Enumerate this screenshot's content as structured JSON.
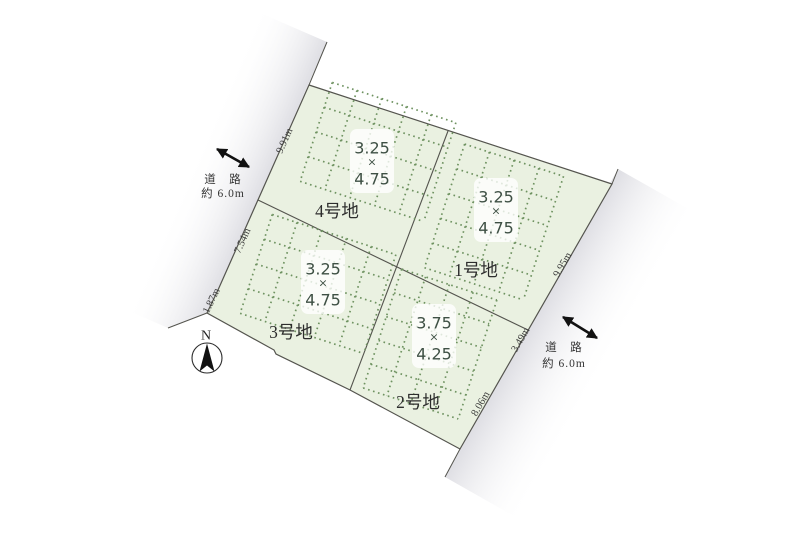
{
  "diagram": {
    "compass_label": "N",
    "roads": {
      "west": {
        "line1": "道　路",
        "line2": "約 6.0m"
      },
      "east": {
        "line1": "道　路",
        "line2": "約 6.0m"
      }
    },
    "lots": [
      {
        "name": "1号地",
        "dim_w": "3.25",
        "dim_x": "×",
        "dim_h": "4.75"
      },
      {
        "name": "2号地",
        "dim_w": "3.75",
        "dim_x": "×",
        "dim_h": "4.25"
      },
      {
        "name": "3号地",
        "dim_w": "3.25",
        "dim_x": "×",
        "dim_h": "4.75"
      },
      {
        "name": "4号地",
        "dim_w": "3.25",
        "dim_x": "×",
        "dim_h": "4.75"
      }
    ],
    "measurements": {
      "west_top": "9.91m",
      "west_mid": "7.54m",
      "west_bottom": "1.87m",
      "east_top": "9.95m",
      "east_mid": "3.49m",
      "east_bottom": "8.06m"
    },
    "colors": {
      "plot_fill": "#eaf1e1",
      "grid_dots": "#6e9260",
      "boundary": "#54544e",
      "road_band": "#e0e0e5"
    }
  }
}
